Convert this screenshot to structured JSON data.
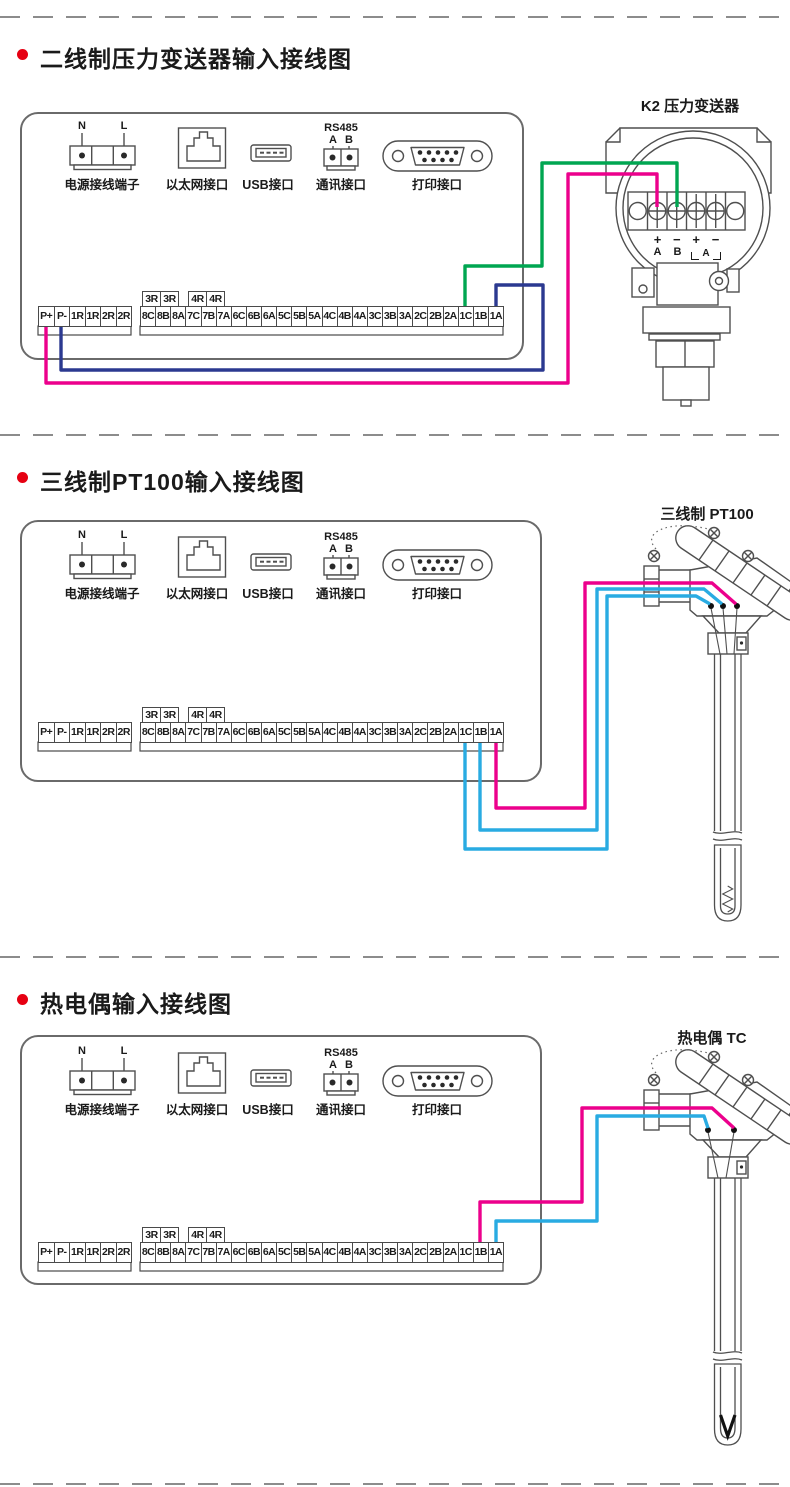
{
  "colors": {
    "magenta": "#EC008C",
    "blue": "#2B3990",
    "green": "#00A651",
    "cyan": "#29ABE2",
    "bullet_red": "#E60012",
    "line_gray": "#4f4f4f",
    "divider_gray": "#8c8c8c"
  },
  "sections": [
    {
      "title": "二线制压力变送器输入接线图",
      "sensor_label": "K2 压力变送器"
    },
    {
      "title": "三线制PT100输入接线图",
      "sensor_label": "三线制 PT100"
    },
    {
      "title": "热电偶输入接线图",
      "sensor_label": "热电偶 TC"
    }
  ],
  "panel_ports": {
    "power": {
      "label": "电源接线端子",
      "pin_left": "N",
      "pin_right": "L"
    },
    "ethernet": {
      "label": "以太网接口"
    },
    "usb": {
      "label": "USB接口"
    },
    "comm": {
      "label": "通讯接口",
      "bus": "RS485",
      "pin_a": "A",
      "pin_b": "B"
    },
    "printer": {
      "label": "打印接口"
    }
  },
  "terminal_strip": {
    "left_cells": [
      "P+",
      "P-",
      "1R",
      "1R",
      "2R",
      "2R"
    ],
    "boxes_left": [
      "3R",
      "3R"
    ],
    "boxes_right": [
      "4R",
      "4R"
    ],
    "main_cells": [
      "8C",
      "8B",
      "8A",
      "7C",
      "7B",
      "7A",
      "6C",
      "6B",
      "6A",
      "5C",
      "5B",
      "5A",
      "4C",
      "4B",
      "4A",
      "3C",
      "3B",
      "3A",
      "2C",
      "2B",
      "2A",
      "1C",
      "1B",
      "1A"
    ]
  },
  "transmitter": {
    "terminal_signs": [
      "+",
      "−",
      "+",
      "−"
    ],
    "terminal_pins": [
      "A",
      "B"
    ],
    "bracket_pin": "A"
  },
  "wires": {
    "section1": [
      {
        "color": "magenta",
        "from": "P+",
        "to": "transmitter + A"
      },
      {
        "color": "blue",
        "from": "P-",
        "to": "1A"
      },
      {
        "color": "green",
        "from": "1C",
        "to": "transmitter − B"
      }
    ],
    "section2": [
      {
        "color": "magenta",
        "from": "1A",
        "to": "PT100 right terminal"
      },
      {
        "color": "cyan",
        "from": "1B",
        "to": "PT100 middle terminal"
      },
      {
        "color": "cyan",
        "from": "1C",
        "to": "PT100 left terminal"
      }
    ],
    "section3": [
      {
        "color": "magenta",
        "from": "1B",
        "to": "TC right terminal"
      },
      {
        "color": "cyan",
        "from": "1A",
        "to": "TC left terminal"
      }
    ]
  }
}
